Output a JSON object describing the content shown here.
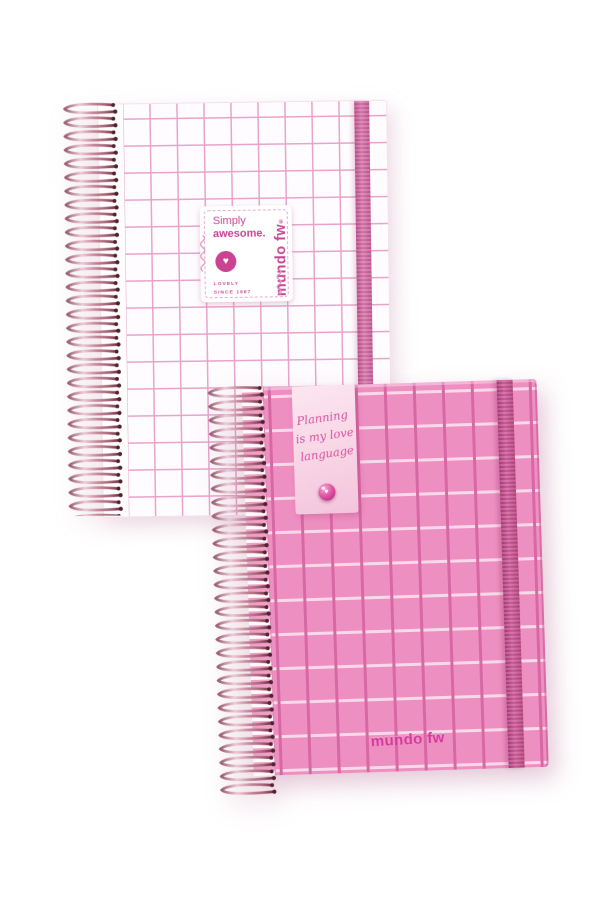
{
  "scene": {
    "type": "product-photo",
    "description": "Two mundo fw spiral-bound grid notebooks with elastic closure bands; a white one with pink grid behind and a pink one with grid in front",
    "background_color": "#ffffff"
  },
  "brand": {
    "name": "mundo fw",
    "registered_mark": "®"
  },
  "icons": {
    "heart_glyph": "♥"
  },
  "notebook_white": {
    "name": "white grid notebook",
    "cover_color": "#fefcfe",
    "grid_line_color": "#e79fc8",
    "elastic_color": "#d2669f",
    "spiral_color": "#c98ca0",
    "label": {
      "title_line1": "Simply",
      "title_line2": "awesome.",
      "tagline_line1": "LOVELY",
      "tagline_line2": "SINCE 1987",
      "brand_vertical": "mundo fw",
      "text_color": "#cc4595"
    }
  },
  "notebook_pink": {
    "name": "pink grid notebook",
    "cover_color": "#ee8fc1",
    "grid_vertical_line_color": "#d868a4",
    "grid_horizontal_line_color": "#f8d9e9",
    "elastic_color": "#c64d90",
    "spiral_color": "#c98ca0",
    "tag": {
      "script_line1": "Planning",
      "script_line2": "is my love",
      "script_line3": "language",
      "background_color": "#f8d9e8",
      "text_color": "#d94f9e"
    },
    "brand_bottom": "mundo fw"
  }
}
